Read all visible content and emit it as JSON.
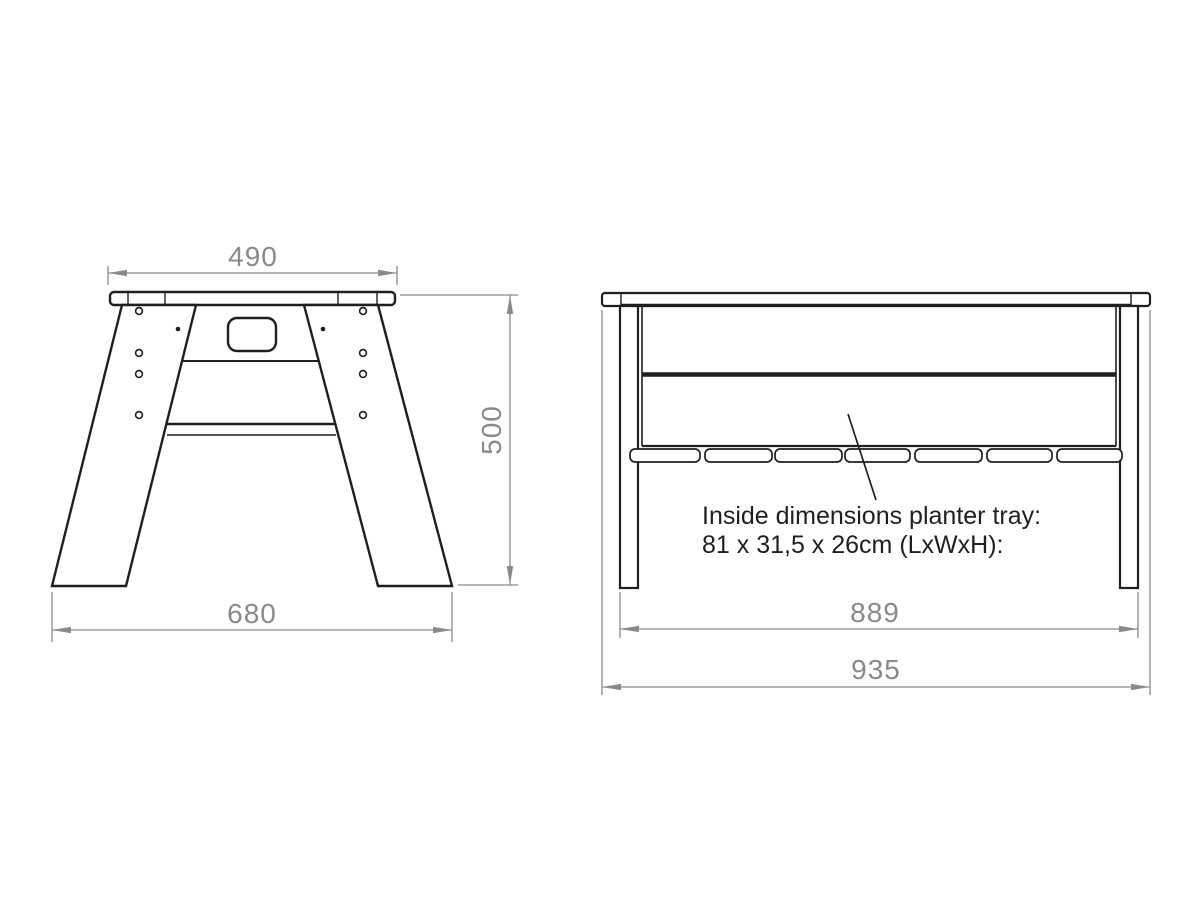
{
  "page": {
    "background": "#ffffff"
  },
  "drawing": {
    "colors": {
      "line": "#1f1f1f",
      "dimension": "#8a8a8a"
    },
    "side_view": {
      "dims": {
        "top_width": "490",
        "bottom_width": "680",
        "height": "500"
      }
    },
    "front_view": {
      "dims": {
        "legs_outer_width": "889",
        "total_width": "935"
      }
    },
    "annotation": {
      "line1": "Inside dimensions planter tray:",
      "line2": "81 x 31,5 x 26cm (LxWxH):"
    }
  }
}
